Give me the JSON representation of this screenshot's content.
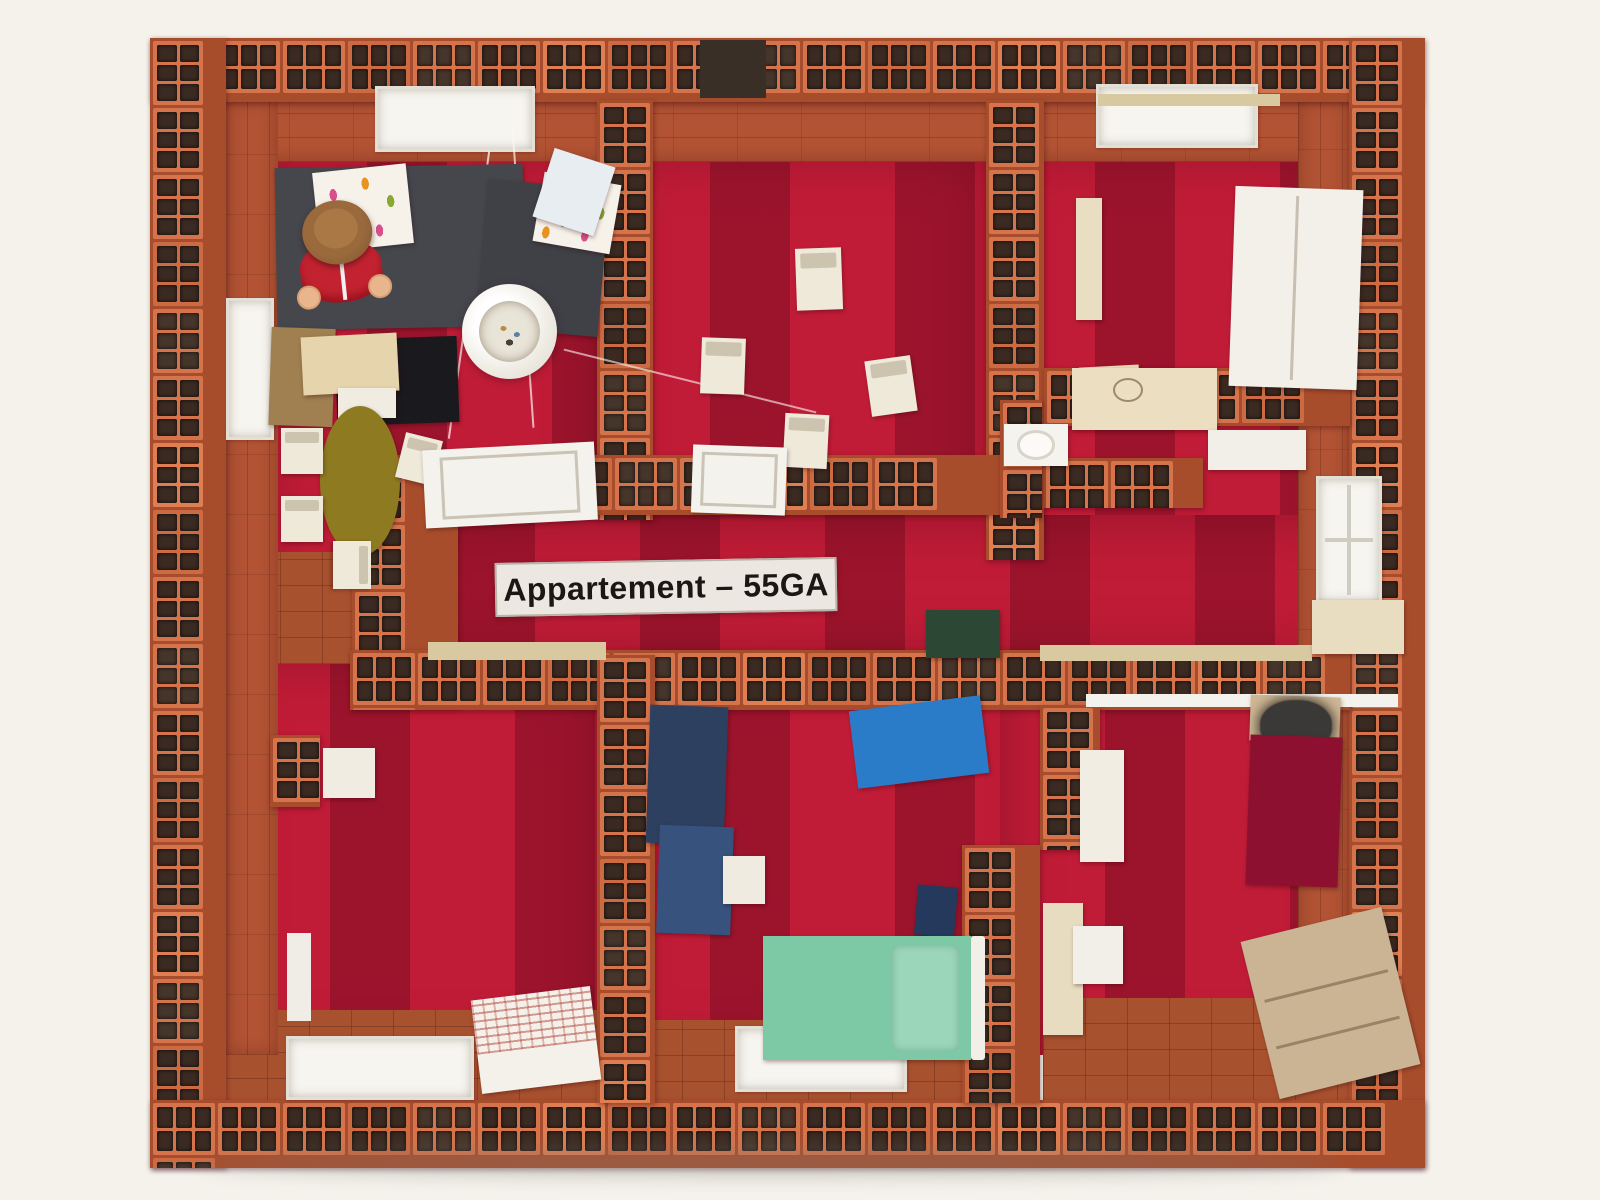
{
  "scene": {
    "description": "Top-down photograph of a miniature apartment model built from small terracotta hollow clay bricks, with crimson painted floors, white dollhouse furniture, beds, a paper pendant lamp and a toy figure.",
    "width": 1600,
    "height": 1200,
    "background": "#f5f2ec"
  },
  "colors": {
    "brick": "#d5744c",
    "brick_mortar": "#a84d2c",
    "brick_slot": "#3a2a21",
    "floor_crimson": "#c11c37",
    "floor_tile": "#a8512f",
    "white_furniture": "#f2efe8",
    "cream": "#ead9b5"
  },
  "sign": {
    "text": "Appartement – 55GA",
    "x": 495,
    "y": 560,
    "w": 342,
    "h": 54,
    "rot": -1
  },
  "figure": {
    "x": 296,
    "y": 208
  },
  "lamp": {
    "x": 462,
    "y": 284,
    "d": 95
  },
  "floors": [
    {
      "name": "floor-living-room",
      "x": 262,
      "y": 150,
      "w": 343,
      "h": 515
    },
    {
      "name": "floor-dining-room",
      "x": 605,
      "y": 150,
      "w": 385,
      "h": 370
    },
    {
      "name": "floor-top-right-room",
      "x": 990,
      "y": 150,
      "w": 362,
      "h": 285
    },
    {
      "name": "floor-bathroom",
      "x": 990,
      "y": 370,
      "w": 362,
      "h": 290
    },
    {
      "name": "floor-hallway",
      "x": 350,
      "y": 515,
      "w": 1000,
      "h": 145
    },
    {
      "name": "floor-bottom-left-room",
      "x": 225,
      "y": 655,
      "w": 380,
      "h": 400
    },
    {
      "name": "floor-bedroom-middle",
      "x": 605,
      "y": 655,
      "w": 445,
      "h": 400
    },
    {
      "name": "floor-bedroom-right",
      "x": 1000,
      "y": 655,
      "w": 352,
      "h": 400
    }
  ],
  "tiles": [
    {
      "name": "tile-floor-living",
      "x": 238,
      "y": 552,
      "w": 132,
      "h": 112
    },
    {
      "name": "tile-floor-bottom-left",
      "x": 225,
      "y": 1010,
      "w": 378,
      "h": 95
    },
    {
      "name": "tile-floor-bottom-middle",
      "x": 640,
      "y": 1020,
      "w": 372,
      "h": 88
    },
    {
      "name": "tile-floor-bottom-right",
      "x": 1043,
      "y": 998,
      "w": 308,
      "h": 104
    }
  ],
  "smooth": [
    {
      "name": "inner-face-top",
      "x": 225,
      "y": 100,
      "w": 1125,
      "h": 62,
      "dir": "h"
    },
    {
      "name": "inner-face-left",
      "x": 225,
      "y": 100,
      "w": 53,
      "h": 955,
      "dir": "v"
    },
    {
      "name": "inner-face-right",
      "x": 1298,
      "y": 100,
      "w": 52,
      "h": 950,
      "dir": "v"
    }
  ],
  "walls": [
    {
      "name": "outer-wall-top",
      "x": 150,
      "y": 38,
      "w": 1272,
      "h": 64,
      "dir": "h"
    },
    {
      "name": "outer-wall-left",
      "x": 150,
      "y": 38,
      "w": 76,
      "h": 1130,
      "dir": "v"
    },
    {
      "name": "outer-wall-right",
      "x": 1349,
      "y": 38,
      "w": 76,
      "h": 1130,
      "dir": "v"
    },
    {
      "name": "outer-wall-bottom",
      "x": 150,
      "y": 1100,
      "w": 1275,
      "h": 68,
      "dir": "h"
    },
    {
      "name": "wall-living-dining",
      "x": 597,
      "y": 100,
      "w": 56,
      "h": 420,
      "dir": "v"
    },
    {
      "name": "wall-dining-right",
      "x": 986,
      "y": 100,
      "w": 58,
      "h": 460,
      "dir": "v"
    },
    {
      "name": "wall-hall-top",
      "x": 352,
      "y": 455,
      "w": 648,
      "h": 60,
      "dir": "h"
    },
    {
      "name": "wall-hall-west",
      "x": 352,
      "y": 455,
      "w": 106,
      "h": 252,
      "dir": "v"
    },
    {
      "name": "wall-hall-bottom",
      "x": 350,
      "y": 650,
      "w": 1000,
      "h": 60,
      "dir": "h"
    },
    {
      "name": "wall-topright-bath",
      "x": 1044,
      "y": 368,
      "w": 306,
      "h": 58,
      "dir": "h"
    },
    {
      "name": "wall-bath-inner",
      "x": 1043,
      "y": 458,
      "w": 160,
      "h": 50,
      "dir": "h"
    },
    {
      "name": "wall-bath-stub",
      "x": 1000,
      "y": 400,
      "w": 42,
      "h": 118,
      "dir": "v"
    },
    {
      "name": "wall-bottomleft-bedroom",
      "x": 597,
      "y": 655,
      "w": 58,
      "h": 448,
      "dir": "v"
    },
    {
      "name": "wall-bedrooms-upper",
      "x": 1040,
      "y": 705,
      "w": 60,
      "h": 145,
      "dir": "v"
    },
    {
      "name": "wall-bedrooms-lower",
      "x": 962,
      "y": 845,
      "w": 78,
      "h": 258,
      "dir": "v"
    },
    {
      "name": "loose-brick-piece",
      "x": 270,
      "y": 735,
      "w": 50,
      "h": 72,
      "dir": "v"
    }
  ],
  "windows": [
    {
      "name": "window-top-living",
      "x": 375,
      "y": 86,
      "w": 160,
      "h": 66
    },
    {
      "name": "window-top-right",
      "x": 1096,
      "y": 84,
      "w": 162,
      "h": 64
    },
    {
      "name": "window-left",
      "x": 226,
      "y": 298,
      "w": 48,
      "h": 142
    },
    {
      "name": "window-right",
      "x": 1316,
      "y": 476,
      "w": 66,
      "h": 128,
      "panes": true
    },
    {
      "name": "window-bottom-middle",
      "x": 735,
      "y": 1026,
      "w": 172,
      "h": 66
    },
    {
      "name": "window-bottom-left",
      "x": 286,
      "y": 1036,
      "w": 188,
      "h": 64
    }
  ],
  "trim": [
    {
      "name": "doorway-dark",
      "x": 700,
      "y": 40,
      "w": 66,
      "h": 58,
      "color": "#3a2f27"
    },
    {
      "name": "wood-lintel",
      "x": 428,
      "y": 642,
      "w": 178,
      "h": 18,
      "color": "#d9c9a0"
    },
    {
      "name": "wood-lintel",
      "x": 1040,
      "y": 645,
      "w": 272,
      "h": 16,
      "color": "#d9c9a0"
    },
    {
      "name": "wood-lintel",
      "x": 1098,
      "y": 94,
      "w": 182,
      "h": 12,
      "color": "#d9c9a0"
    },
    {
      "name": "white-lintel",
      "x": 1086,
      "y": 694,
      "w": 312,
      "h": 13,
      "color": "#f4f2ec"
    },
    {
      "name": "door-jamb",
      "x": 287,
      "y": 933,
      "w": 24,
      "h": 88,
      "color": "#f0ede6"
    },
    {
      "name": "hanging-string",
      "x": 468,
      "y": 150,
      "w": 2,
      "h": 290,
      "color": "rgba(250,248,244,0.75)",
      "rot": 8
    },
    {
      "name": "hanging-string",
      "x": 522,
      "y": 128,
      "w": 2,
      "h": 300,
      "color": "rgba(250,248,244,0.7)",
      "rot": -4
    },
    {
      "name": "hanging-string",
      "x": 560,
      "y": 380,
      "w": 260,
      "h": 2,
      "color": "rgba(250,248,244,0.6)",
      "rot": 14
    },
    {
      "name": "ground-shadow",
      "x": 200,
      "y": 1152,
      "w": 1140,
      "h": 22,
      "color": "rgba(130,120,110,0.45)",
      "blur": 10
    }
  ],
  "furniture": [
    {
      "name": "sofa",
      "x": 276,
      "y": 166,
      "w": 248,
      "h": 162,
      "color": "#45474d",
      "rot": -1
    },
    {
      "name": "sofa-chaise",
      "x": 482,
      "y": 184,
      "w": 122,
      "h": 148,
      "color": "#3f4147",
      "rot": 5
    },
    {
      "name": "cushion",
      "x": 316,
      "y": 168,
      "w": 94,
      "h": 80,
      "kind": "dots",
      "rot": -6
    },
    {
      "name": "cushion",
      "x": 538,
      "y": 178,
      "w": 78,
      "h": 70,
      "kind": "dots",
      "rot": 10
    },
    {
      "name": "cardboard-stack",
      "x": 270,
      "y": 328,
      "w": 64,
      "h": 98,
      "kind": "ridges",
      "color": "#a07f50",
      "rot": 2
    },
    {
      "name": "black-crate",
      "x": 336,
      "y": 338,
      "w": 122,
      "h": 86,
      "color": "#1a191d",
      "rot": -2
    },
    {
      "name": "kitchen-counter",
      "x": 302,
      "y": 335,
      "w": 96,
      "h": 58,
      "color": "#e6d4ac",
      "rot": -3
    },
    {
      "name": "counter-base",
      "x": 338,
      "y": 388,
      "w": 58,
      "h": 30,
      "color": "#f0ece1"
    },
    {
      "name": "dining-table",
      "x": 320,
      "y": 406,
      "w": 80,
      "h": 150,
      "color": "#8e7b21",
      "kind": "oval"
    },
    {
      "name": "chair",
      "x": 281,
      "y": 428,
      "w": 42,
      "h": 46,
      "color": "#efe9da",
      "kind": "chair"
    },
    {
      "name": "chair",
      "x": 281,
      "y": 496,
      "w": 42,
      "h": 46,
      "color": "#efe9da",
      "kind": "chair"
    },
    {
      "name": "chair",
      "x": 400,
      "y": 436,
      "w": 38,
      "h": 46,
      "color": "#efe9da",
      "kind": "chair",
      "rot": 14
    },
    {
      "name": "chair",
      "x": 328,
      "y": 546,
      "w": 48,
      "h": 38,
      "color": "#efe9da",
      "kind": "chair",
      "rot": 90
    },
    {
      "name": "paper-sheets",
      "x": 542,
      "y": 156,
      "w": 64,
      "h": 72,
      "color": "#e8edf2",
      "rot": 18
    },
    {
      "name": "chair",
      "x": 796,
      "y": 248,
      "w": 46,
      "h": 62,
      "color": "#efe9da",
      "kind": "chair",
      "rot": -2
    },
    {
      "name": "chair",
      "x": 701,
      "y": 338,
      "w": 44,
      "h": 56,
      "color": "#efe9da",
      "kind": "chair",
      "rot": 2
    },
    {
      "name": "chair",
      "x": 868,
      "y": 358,
      "w": 46,
      "h": 56,
      "color": "#efe9da",
      "kind": "chair",
      "rot": -8
    },
    {
      "name": "chair",
      "x": 784,
      "y": 414,
      "w": 44,
      "h": 54,
      "color": "#efe9da",
      "kind": "chair",
      "rot": 3
    },
    {
      "name": "wardrobe",
      "x": 1232,
      "y": 188,
      "w": 128,
      "h": 200,
      "color": "#f3f0e9",
      "kind": "panel",
      "rot": 2
    },
    {
      "name": "wall-shelf",
      "x": 1076,
      "y": 198,
      "w": 26,
      "h": 122,
      "color": "#e9ddc2"
    },
    {
      "name": "storage-box",
      "x": 1080,
      "y": 366,
      "w": 60,
      "h": 52,
      "color": "#ead9b5",
      "rot": -3
    },
    {
      "name": "appliance",
      "x": 1072,
      "y": 368,
      "w": 145,
      "h": 62,
      "color": "#ecdec0",
      "kind": "circle"
    },
    {
      "name": "toilet",
      "x": 1004,
      "y": 424,
      "w": 64,
      "h": 42,
      "color": "#f5f3ee",
      "kind": "toilet"
    },
    {
      "name": "bathtub-edge",
      "x": 1208,
      "y": 430,
      "w": 98,
      "h": 40,
      "color": "#f2efe8"
    },
    {
      "name": "door-panel",
      "x": 424,
      "y": 446,
      "w": 172,
      "h": 78,
      "color": "#f4f2ec",
      "kind": "doorframe",
      "rot": -3
    },
    {
      "name": "door-panel",
      "x": 692,
      "y": 446,
      "w": 94,
      "h": 68,
      "color": "#f4f2ec",
      "kind": "doorframe",
      "rot": 2
    },
    {
      "name": "door-panel",
      "x": 1312,
      "y": 600,
      "w": 92,
      "h": 54,
      "color": "#e9ddc1"
    },
    {
      "name": "green-mat",
      "x": 926,
      "y": 610,
      "w": 74,
      "h": 48,
      "color": "#2c4733"
    },
    {
      "name": "wall-cabinet",
      "x": 323,
      "y": 748,
      "w": 52,
      "h": 50,
      "color": "#f1ece2"
    },
    {
      "name": "sketched-box",
      "x": 476,
      "y": 993,
      "w": 120,
      "h": 94,
      "kind": "sketch",
      "rot": -7
    },
    {
      "name": "bed-navy",
      "x": 648,
      "y": 706,
      "w": 78,
      "h": 138,
      "color": "#2d4060",
      "rot": 2
    },
    {
      "name": "rug-navy",
      "x": 658,
      "y": 826,
      "w": 74,
      "h": 108,
      "color": "#36527d",
      "kind": "stripes",
      "rot": 2
    },
    {
      "name": "nightstand",
      "x": 723,
      "y": 856,
      "w": 42,
      "h": 48,
      "color": "#f0ebe0"
    },
    {
      "name": "bed-blue",
      "x": 853,
      "y": 703,
      "w": 132,
      "h": 78,
      "color": "#2a7cc9",
      "rot": -7
    },
    {
      "name": "box-navy",
      "x": 916,
      "y": 886,
      "w": 40,
      "h": 50,
      "color": "#24395c",
      "rot": 5
    },
    {
      "name": "bed-green",
      "x": 763,
      "y": 936,
      "w": 208,
      "h": 124,
      "color": "#7ec9a5",
      "kind": "bed"
    },
    {
      "name": "bench",
      "x": 1080,
      "y": 750,
      "w": 44,
      "h": 112,
      "color": "#f1ede3"
    },
    {
      "name": "headboard",
      "x": 1250,
      "y": 696,
      "w": 90,
      "h": 46,
      "color": "#ccb693",
      "rot": 2
    },
    {
      "name": "pillow-fuzzy",
      "x": 1260,
      "y": 700,
      "w": 72,
      "h": 52,
      "color": "#3b3937",
      "kind": "fuzzy"
    },
    {
      "name": "bed-red",
      "x": 1248,
      "y": 736,
      "w": 92,
      "h": 150,
      "color": "#8e1030",
      "rot": 2
    },
    {
      "name": "dresser",
      "x": 1258,
      "y": 922,
      "w": 145,
      "h": 162,
      "color": "#cab494",
      "kind": "drawers",
      "rot": -14
    },
    {
      "name": "door-cream",
      "x": 1043,
      "y": 903,
      "w": 40,
      "h": 132,
      "color": "#e8dcc0"
    },
    {
      "name": "door-hook",
      "x": 1073,
      "y": 926,
      "w": 50,
      "h": 58,
      "color": "#f2efe8"
    }
  ]
}
